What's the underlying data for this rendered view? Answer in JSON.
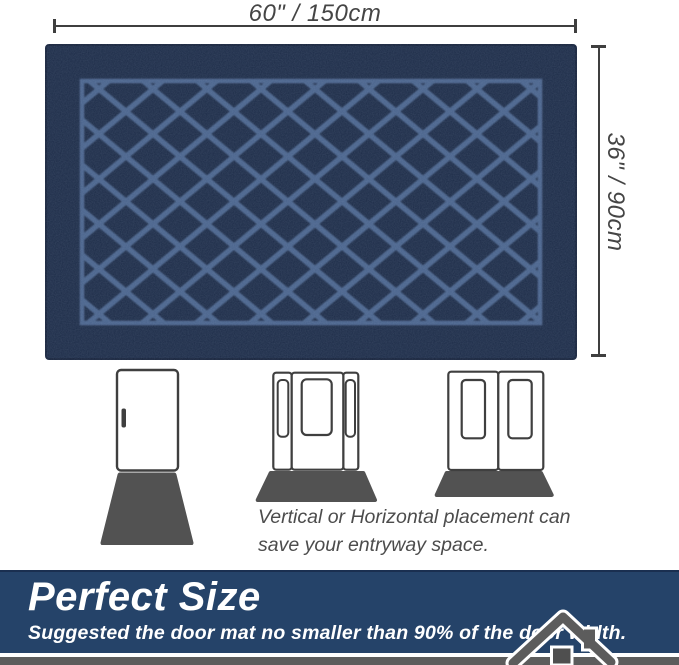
{
  "dimensions": {
    "width_label": "60\" / 150cm",
    "height_label": "36\" / 90cm"
  },
  "mat": {
    "pattern": "diamond-lattice",
    "base_color": "#1c2b47",
    "pattern_color": "#4a648c",
    "edge_color": "#15213a"
  },
  "placement_note": {
    "line1": "Vertical or Horizontal placement can",
    "line2": "save your entryway space."
  },
  "figures": [
    {
      "icon": "single-door-vertical-mat-icon"
    },
    {
      "icon": "sidelight-door-horizontal-mat-icon"
    },
    {
      "icon": "double-door-horizontal-mat-icon"
    }
  ],
  "banner": {
    "title": "Perfect Size",
    "subtitle": "Suggested the door mat no smaller than 90% of the door width.",
    "bg_color": "#254369",
    "text_color": "#ffffff"
  },
  "icons": {
    "house": "house-icon"
  },
  "colors": {
    "dimension_lines": "#3f3f3f",
    "door_outline": "#3f3f3f",
    "figure_mat": "#525252",
    "ground_strip": "#5c5c5c"
  }
}
